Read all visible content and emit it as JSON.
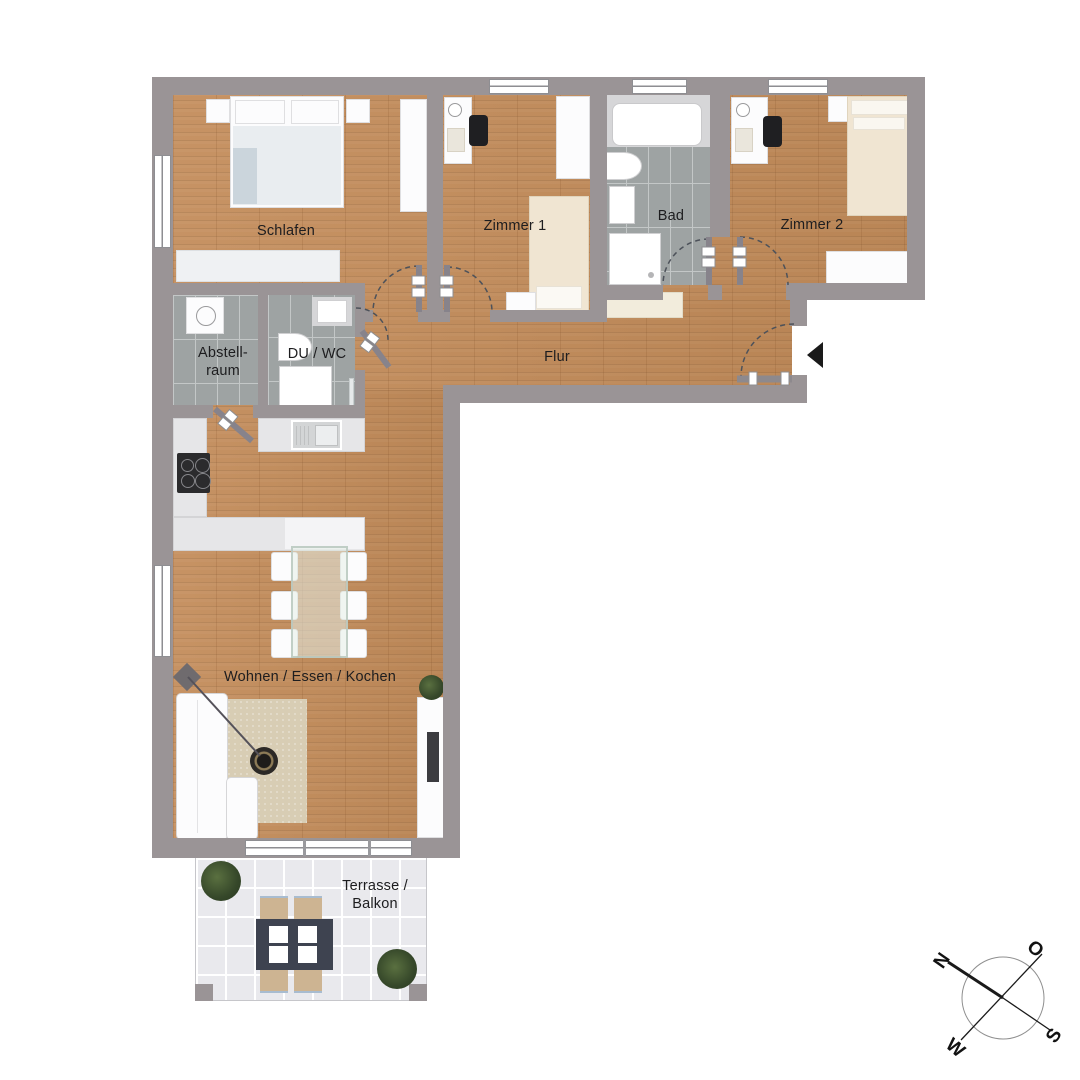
{
  "labels": {
    "schlafen": "Schlafen",
    "zimmer1": "Zimmer 1",
    "bad": "Bad",
    "zimmer2": "Zimmer 2",
    "abstellraum_line1": "Abstell-",
    "abstellraum_line2": "raum",
    "du_wc": "DU / WC",
    "flur": "Flur",
    "wohnen": "Wohnen / Essen / Kochen",
    "terrasse_line1": "Terrasse /",
    "terrasse_line2": "Balkon"
  },
  "compass": {
    "north": "N",
    "east": "O",
    "south": "S",
    "west": "W"
  },
  "icons": {
    "entry_marker": "entrance-triangle",
    "compass": "compass-rose"
  },
  "colors": {
    "wall": "#9a9496",
    "wood_floor": "#c38c5a",
    "bathroom_tile": "#9ea3a3",
    "terrace_tile": "#e9e9ed",
    "counter": "#e6e6e8",
    "bed_cream": "#f0e5d2",
    "entry_marker": "#1a1a1a"
  }
}
